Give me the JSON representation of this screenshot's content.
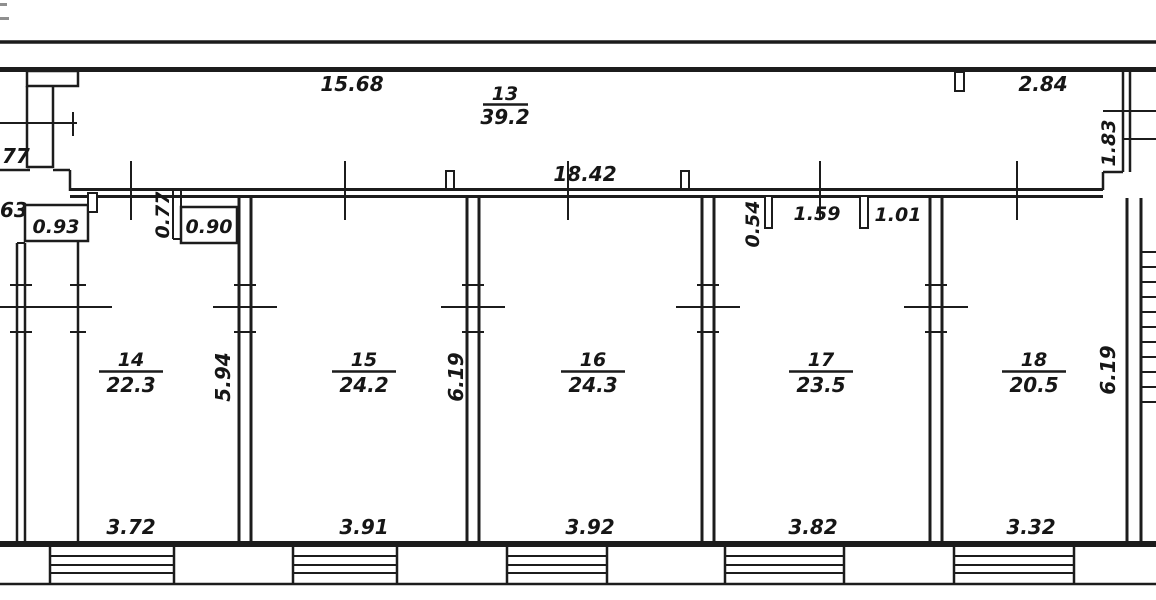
{
  "plan": {
    "background": "#ffffff",
    "line_color": "#1c1c1c",
    "corridor": {
      "number": "13",
      "area": "39.2",
      "length_dim": "15.68",
      "right_dim": "2.84",
      "inner_dim": "18.42",
      "stair_dim": "1.83"
    },
    "rooms": [
      {
        "number": "14",
        "area": "22.3",
        "width_dim": "3.72",
        "depth_dim": "5.94"
      },
      {
        "number": "15",
        "area": "24.2",
        "width_dim": "3.91",
        "depth_dim": "6.19"
      },
      {
        "number": "16",
        "area": "24.3",
        "width_dim": "3.92"
      },
      {
        "number": "17",
        "area": "23.5",
        "width_dim": "3.82"
      },
      {
        "number": "18",
        "area": "20.5",
        "width_dim": "3.32",
        "depth_dim": "6.19"
      }
    ],
    "openings": {
      "niche_left": "0.93",
      "door_left": "0.77",
      "niche_right": "0.90",
      "door_mid": "0.54",
      "span_mid": "1.59",
      "door_right": "1.01"
    },
    "edge_labels": {
      "upper": "77",
      "lower": "63"
    }
  }
}
